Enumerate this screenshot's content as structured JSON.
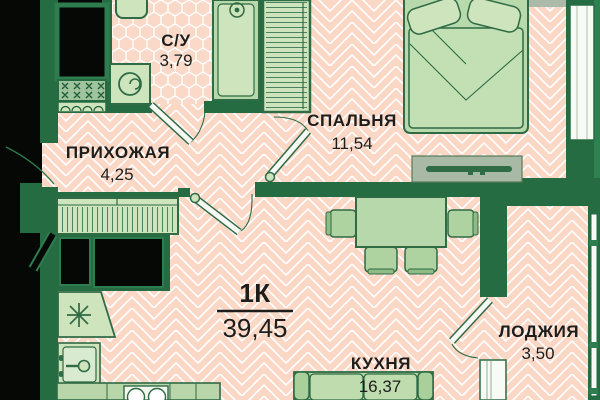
{
  "plan": {
    "flat_type": "1К",
    "total_area": "39,45",
    "rooms": [
      {
        "name": "С/У",
        "area": "3,79"
      },
      {
        "name": "ПРИХОЖАЯ",
        "area": "4,25"
      },
      {
        "name": "СПАЛЬНЯ",
        "area": "11,54"
      },
      {
        "name": "КУХНЯ",
        "area": "16,37"
      },
      {
        "name": "ЛОДЖИЯ",
        "area": "3,50"
      }
    ],
    "colors": {
      "wall": "#266c42",
      "exterior": "#2f814f",
      "floor": "#fbd8c6",
      "floor_line": "#ffffff",
      "furniture_light": "#cde4bd",
      "furniture_medium": "#b7d8aa",
      "outline": "#2f6b45",
      "void": "#050805",
      "stand_gray": "#a8b9a5",
      "text": "#1d1d1b"
    }
  }
}
